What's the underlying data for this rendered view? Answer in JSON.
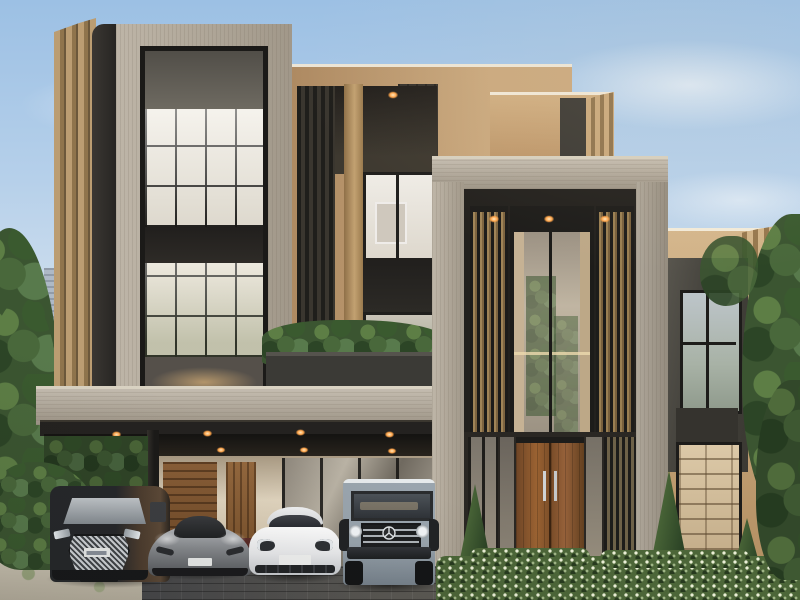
{
  "meta": {
    "description": "Photorealistic exterior render of a modern three-storey luxury villa with travertine frames, bronze fins and slatted screens, glass curtain walls, a planted balcony, a double-height timber entry door, a carport with four luxury cars, clipped hedges, flanking trees and a hazy city skyline at left under a pale blue sky"
  },
  "palette": {
    "sky_top": "#9cc0e4",
    "sky_horizon": "#e9eae6",
    "travertine": "#b3a999",
    "travertine_shadow": "#93897a",
    "beige_stucco": "#b99570",
    "beige_dark": "#a18055",
    "bronze_dark": "#332f2a",
    "charcoal": "#201e1c",
    "interior_warm": "#eae3d4",
    "wood_door": "#8a5a33",
    "hedge_green": "#4c6638",
    "warm_light": "#ffa449",
    "skyline_haze": "#b7c0cd",
    "driveway_gray": "#46474a"
  },
  "scene": {
    "house": {
      "storeys": 3,
      "elements": [
        "left window tower with travertine surround and gridded glazing",
        "stepped bronze fins beside left tower",
        "central beige block with ribbed dark cladding, tan pilaster and framed art visible inside",
        "balcony planter box with tropical plants over the carport",
        "double-height entry tower with vertical slat screens and three warm downlights",
        "timber double entry door with steel pull handles",
        "right wing with dark window band and bookshelf window",
        "carport slab with two rows of warm downlights, timber garage wall panels and steel post"
      ]
    },
    "cars": [
      {
        "name": "dark luxury minivan with chrome spindle grille (Lexus LM style)",
        "body_color": "#26282b"
      },
      {
        "name": "grey mid-engine supercar (McLaren style)",
        "body_color": "#888b8f"
      },
      {
        "name": "white sports sedan (Porsche Panamera style)",
        "body_color": "#ebecee"
      },
      {
        "name": "grey-blue boxy SUV with three-pointed star grille (Mercedes G-Class style)",
        "body_color": "#9aa5ae"
      }
    ],
    "landscape": [
      "hazy high-rise skyline at far left",
      "large trees at left and right edges",
      "clipped flowering hedge across the entry forecourt",
      "three conical cypress shrubs",
      "shrub bed and light gravel at lower left",
      "dark paver driveway"
    ],
    "lighting": {
      "carport_downlights": 8,
      "entry_downlights": 3,
      "facade_downlights": 1,
      "time_of_day": "daytime, soft warm sun from right"
    }
  }
}
